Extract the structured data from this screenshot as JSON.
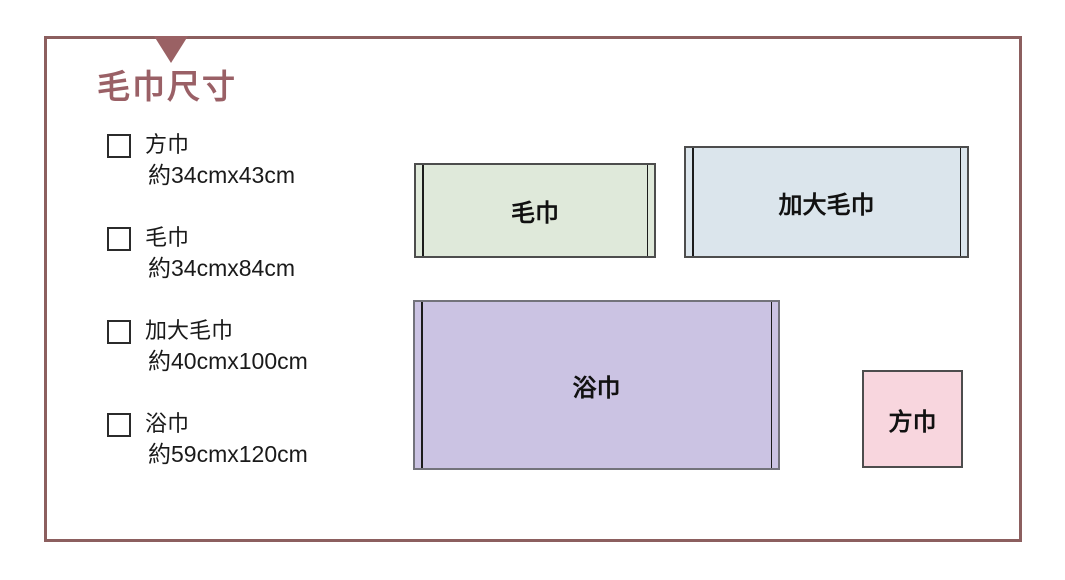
{
  "page": {
    "background": "#ffffff"
  },
  "panel": {
    "border_color": "#8c5f5f"
  },
  "marker": {
    "shape": "down-triangle",
    "color": "#9a6164"
  },
  "title": {
    "text": "毛巾尺寸",
    "color": "#9a6066"
  },
  "checklist": {
    "items": [
      {
        "name": "方巾",
        "size": "約34cmx43cm"
      },
      {
        "name": "毛巾",
        "size": "約34cmx84cm"
      },
      {
        "name": "加大毛巾",
        "size": "約40cmx100cm"
      },
      {
        "name": "浴巾",
        "size": "約59cmx120cm"
      }
    ]
  },
  "diagram": {
    "towels": [
      {
        "label": "毛巾",
        "fill": "#dfe9da",
        "border": "#4d4d4d",
        "hems": true
      },
      {
        "label": "加大毛巾",
        "fill": "#dbe5ec",
        "border": "#4d4d4d",
        "hems": true
      },
      {
        "label": "浴巾",
        "fill": "#cbc3e3",
        "border": "#73737b",
        "hems": true
      },
      {
        "label": "方巾",
        "fill": "#f8d6de",
        "border": "#4d4d4d",
        "hems": false
      }
    ]
  }
}
